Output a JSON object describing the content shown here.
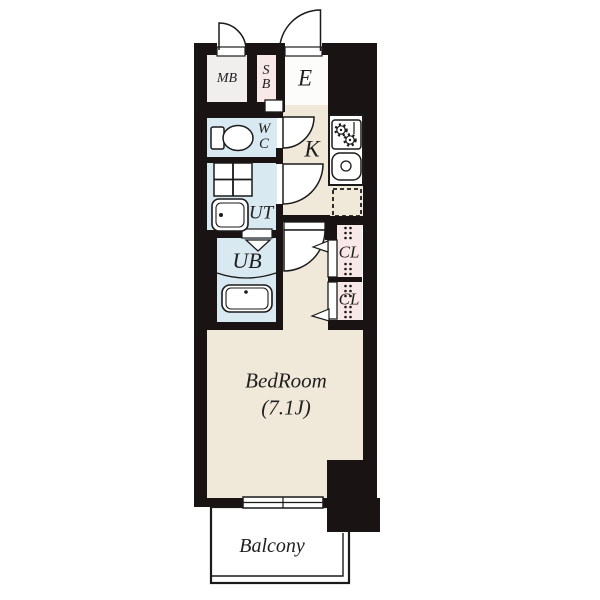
{
  "floorplan": {
    "rooms": {
      "mb": {
        "label": "MB"
      },
      "sb": {
        "line1": "S",
        "line2": "B"
      },
      "entrance": {
        "label": "E"
      },
      "wc": {
        "line1": "W",
        "line2": "C"
      },
      "kitchen": {
        "label": "K"
      },
      "ut": {
        "label": "UT"
      },
      "ub": {
        "label": "UB"
      },
      "closet_upper": {
        "label": "CL"
      },
      "closet_lower": {
        "label": "CL"
      },
      "bedroom": {
        "name": "BedRoom",
        "size": "(7.1J)"
      },
      "balcony": {
        "label": "Balcony"
      }
    },
    "colors": {
      "wall": "#191314",
      "wet-area": "#d9e9f2",
      "storage": "#f8e8e7",
      "floor": "#f0e9da",
      "balcony-floor": "#f7f5db",
      "mb-floor": "#f1efee",
      "entrance-floor": "#fcfcfb",
      "line": "#1a1a1a",
      "label": "#1f1f1f"
    }
  }
}
